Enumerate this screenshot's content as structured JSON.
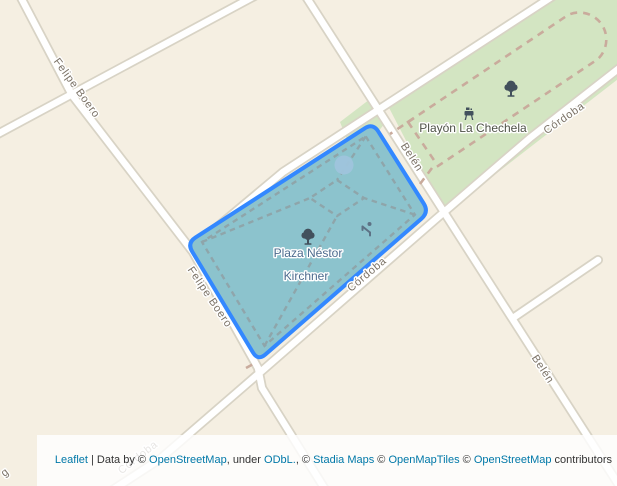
{
  "map": {
    "place_labels": {
      "plaza_line1": "Plaza Néstor",
      "plaza_line2": "Kirchner",
      "playon": "Playón La Chechela"
    },
    "street_labels": {
      "felipe_boero": "Felipe Boero",
      "belen": "Belén",
      "cordoba": "Córdoba",
      "edge_fragment": "g"
    },
    "icons": {
      "tree": "tree-icon",
      "playground": "playground-icon",
      "bbq": "bbq-icon",
      "fountain": "fountain-circle"
    },
    "colors": {
      "land": "#f5efe2",
      "street": "#ffffff",
      "street_casing": "#d8d3c5",
      "park_green": "#d3e5c2",
      "plaza_fill": "#8cc3cd",
      "plaza_stroke": "#3388ff",
      "track_dash": "#c9ab9c",
      "path_dash": "#8fa0a4",
      "fountain": "#9fc4dc",
      "street_label": "#7b7266",
      "plaza_label": "#4c6b8e",
      "playon_label": "#4e5247",
      "icon_dark": "#42505c",
      "icon_playground": "#5d7285",
      "link": "#0078a8",
      "attribution_text": "#333333",
      "attribution_bg": "rgba(255,255,255,0.82)"
    }
  },
  "attribution": {
    "parts": [
      {
        "text": "Leaflet",
        "link": true
      },
      {
        "text": " | Data by © ",
        "link": false
      },
      {
        "text": "OpenStreetMap",
        "link": true
      },
      {
        "text": ", under ",
        "link": false
      },
      {
        "text": "ODbL.",
        "link": true
      },
      {
        "text": ", © ",
        "link": false
      },
      {
        "text": "Stadia Maps",
        "link": true
      },
      {
        "text": " © ",
        "link": false
      },
      {
        "text": "OpenMapTiles",
        "link": true
      },
      {
        "text": " © ",
        "link": false
      },
      {
        "text": "OpenStreetMap",
        "link": true
      },
      {
        "text": " contributors",
        "link": false
      }
    ]
  }
}
